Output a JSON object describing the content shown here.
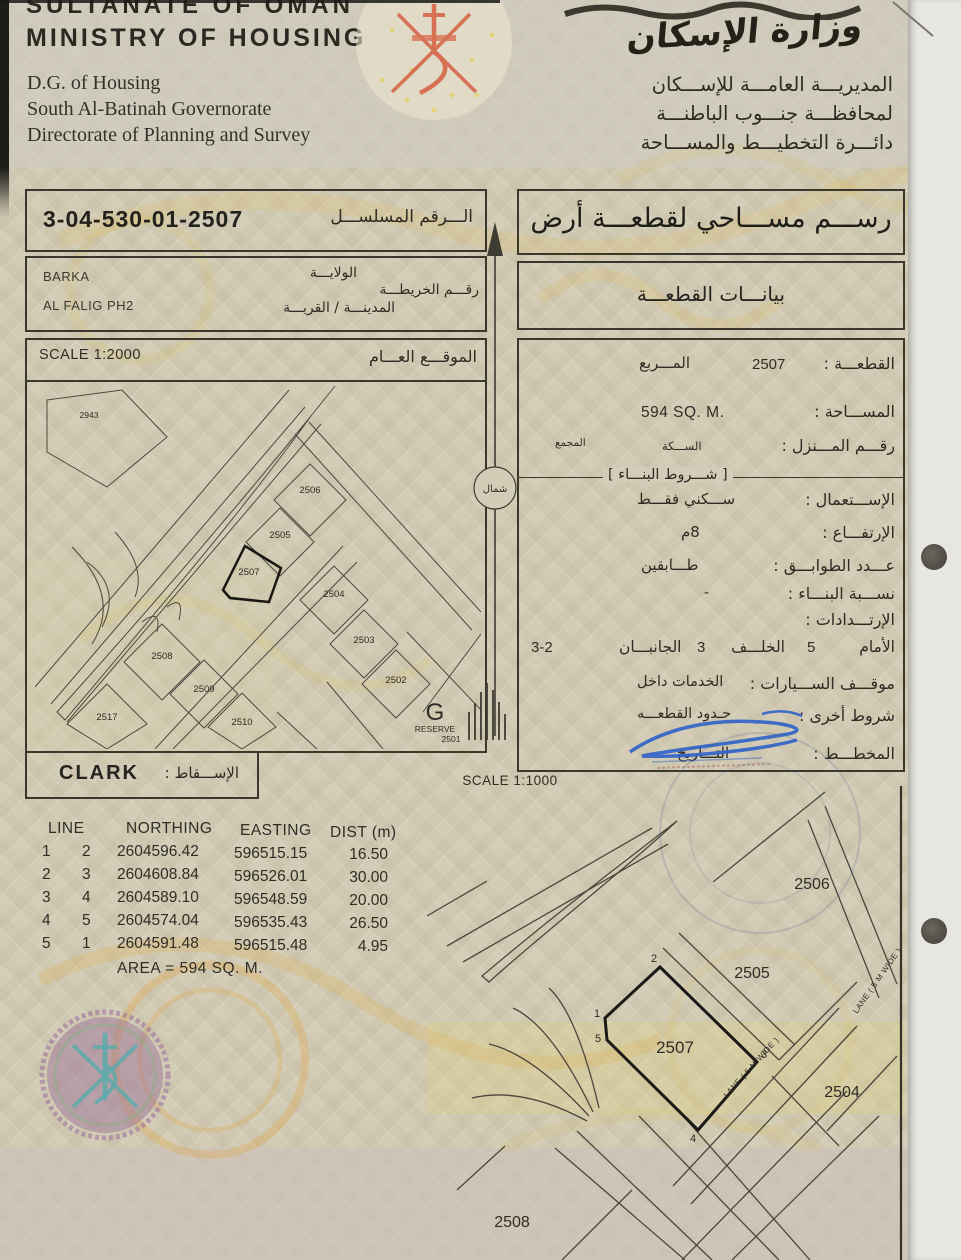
{
  "header": {
    "country": "SULTANATE OF OMAN",
    "ministry": "MINISTRY OF HOUSING",
    "dept_en": [
      "D.G. of Housing",
      "South Al-Batinah Governorate",
      "Directorate of Planning and Survey"
    ],
    "ministry_calligraphy_ar": "وزارة الإسكان",
    "dept_ar": [
      "المديريـــة العامـــة للإســـكان",
      "لمحافظـــة جنـــوب الباطنـــة",
      "دائـــرة التخطيـــط والمســـاحة"
    ]
  },
  "serial_box": {
    "label_ar": "الـــرقم المسلســـل",
    "value": "3-04-530-01-2507"
  },
  "location_box": {
    "wilaya_label_ar": "الولايـــة",
    "wilaya_value": "BARKA",
    "map_number_label_ar": "رقـــم الخريطـــة",
    "city_village_label_ar": "المدينـــة / القريـــة",
    "city_village_value": "AL FALIG PH2"
  },
  "title_box_ar": "رســـم مســـاحي لقطعـــة أرض",
  "subtitle_box_ar": "بيانـــات القطعـــة",
  "general_location_map": {
    "scale_label": "SCALE 1:2000",
    "title_ar": "الموقـــع العـــام",
    "plot_labels": [
      {
        "id": "2943"
      },
      {
        "id": "2506"
      },
      {
        "id": "2505"
      },
      {
        "id": "2507"
      },
      {
        "id": "2504"
      },
      {
        "id": "2503"
      },
      {
        "id": "2502"
      },
      {
        "id": "2508"
      },
      {
        "id": "2509"
      },
      {
        "id": "2517"
      },
      {
        "id": "2510"
      }
    ],
    "reserve": {
      "letter": "G",
      "word": "RESERVE",
      "plot": "2501"
    }
  },
  "north_arrow_label_ar": "شمال",
  "projection_box": {
    "label_ar": "الإســـقاط :",
    "value": "CLARK"
  },
  "plot_details": {
    "plot": {
      "label_ar": "القطعـــة :",
      "value": "2507",
      "square_label_ar": "المـــربع"
    },
    "area": {
      "label_ar": "المســـاحة :",
      "value": "594 SQ. M."
    },
    "house_no": {
      "label_ar": "رقـــم المـــنزل :",
      "street_ar": "الســـكة",
      "complex_ar": "المجمع"
    },
    "building_conditions_header_ar": "[ شـــروط البنـــاء ]",
    "usage": {
      "label_ar": "الإســـتعمال :",
      "value_ar": "ســـكني فقـــط"
    },
    "height": {
      "label_ar": "الإرتفـــاع :",
      "value_ar": "8م"
    },
    "floors": {
      "label_ar": "عـــدد الطوابـــق :",
      "value_ar": "طـــابقين"
    },
    "building_ratio": {
      "label_ar": "نســـبة البنـــاء :",
      "value": "-"
    },
    "setbacks": {
      "label_ar": "الإرتـــدادات :",
      "front_label_ar": "الأمام",
      "front": "5",
      "back_label_ar": "الخلـــف",
      "back": "3",
      "sides_label_ar": "الجانبـــان",
      "sides": "3-2"
    },
    "parking": {
      "label_ar": "موقـــف الســـيارات :",
      "value_ar": "الخدمات داخل"
    },
    "other_conditions": {
      "label_ar": "شروط أخرى :",
      "value_ar": "حـدود القطعـــه"
    },
    "planner": {
      "label_ar": "المخطـــط :",
      "date_label_ar": "التـــاريخ"
    }
  },
  "coordinates_table": {
    "headers": [
      "LINE",
      "NORTHING",
      "EASTING",
      "DIST (m)"
    ],
    "rows": [
      {
        "from": "1",
        "to": "2",
        "northing": "2604596.42",
        "easting": "596515.15",
        "dist": "16.50"
      },
      {
        "from": "2",
        "to": "3",
        "northing": "2604608.84",
        "easting": "596526.01",
        "dist": "30.00"
      },
      {
        "from": "3",
        "to": "4",
        "northing": "2604589.10",
        "easting": "596548.59",
        "dist": "20.00"
      },
      {
        "from": "4",
        "to": "5",
        "northing": "2604574.04",
        "easting": "596535.43",
        "dist": "26.50"
      },
      {
        "from": "5",
        "to": "1",
        "northing": "2604591.48",
        "easting": "596515.48",
        "dist": "4.95"
      }
    ],
    "area_note": "AREA = 594 SQ. M."
  },
  "detail_map": {
    "scale_label": "SCALE 1:1000",
    "plot_labels": [
      {
        "id": "2506"
      },
      {
        "id": "2505"
      },
      {
        "id": "2507"
      },
      {
        "id": "2504"
      },
      {
        "id": "2508"
      }
    ],
    "vertices": [
      "1",
      "2",
      "3",
      "4",
      "5"
    ],
    "lane_label": "LANE ( 5 M WIDE )",
    "lane_label_2": "LANE ( 5 M WIDE )"
  }
}
